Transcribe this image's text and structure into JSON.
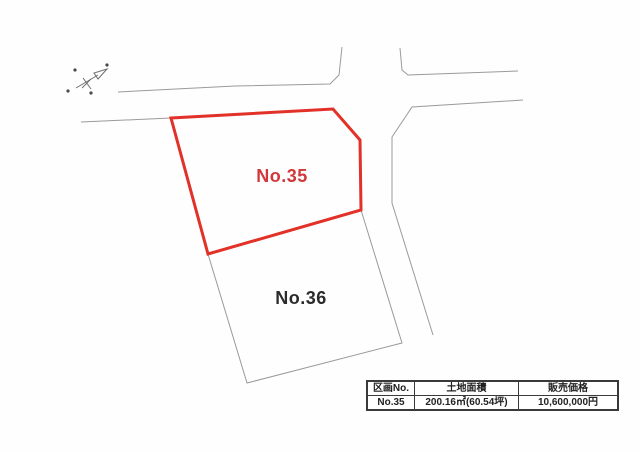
{
  "colors": {
    "background": "#fefefe",
    "plot35_outline": "#e23128",
    "plot35_label": "#d2373c",
    "plot36_outline": "#9a9a9a",
    "plot36_label": "#2b2b2b",
    "road_gray": "#9a9a9a"
  },
  "compass": {
    "icon": "north-arrow"
  },
  "plots": [
    {
      "label": "No.35",
      "points": "171,118 333,109 360,140 361,210 208,254",
      "label_x": 282,
      "label_y": 182,
      "highlighted": true
    },
    {
      "label": "No.36",
      "points": "208,254 361,210 402,343 247,383",
      "label_x": 301,
      "label_y": 304,
      "highlighted": false
    }
  ],
  "roads": [
    {
      "name": "top-road-upper-edge-west",
      "points": "342,47 339,75 330,84 235,86 118,92"
    },
    {
      "name": "top-road-lower-edge-west",
      "points": "81,122 171,118"
    },
    {
      "name": "top-road-upper-edge-east",
      "points": "400,48 402,70 408,75 518,71"
    },
    {
      "name": "side-road-west-edge",
      "points": "523,100 412,107 392,137 392,203 433,335"
    }
  ],
  "table": {
    "headers": [
      "区画No.",
      "土地面積",
      "販売価格"
    ],
    "rows": [
      [
        "No.35",
        "200.16㎡(60.54坪)",
        "10,600,000円"
      ]
    ]
  }
}
